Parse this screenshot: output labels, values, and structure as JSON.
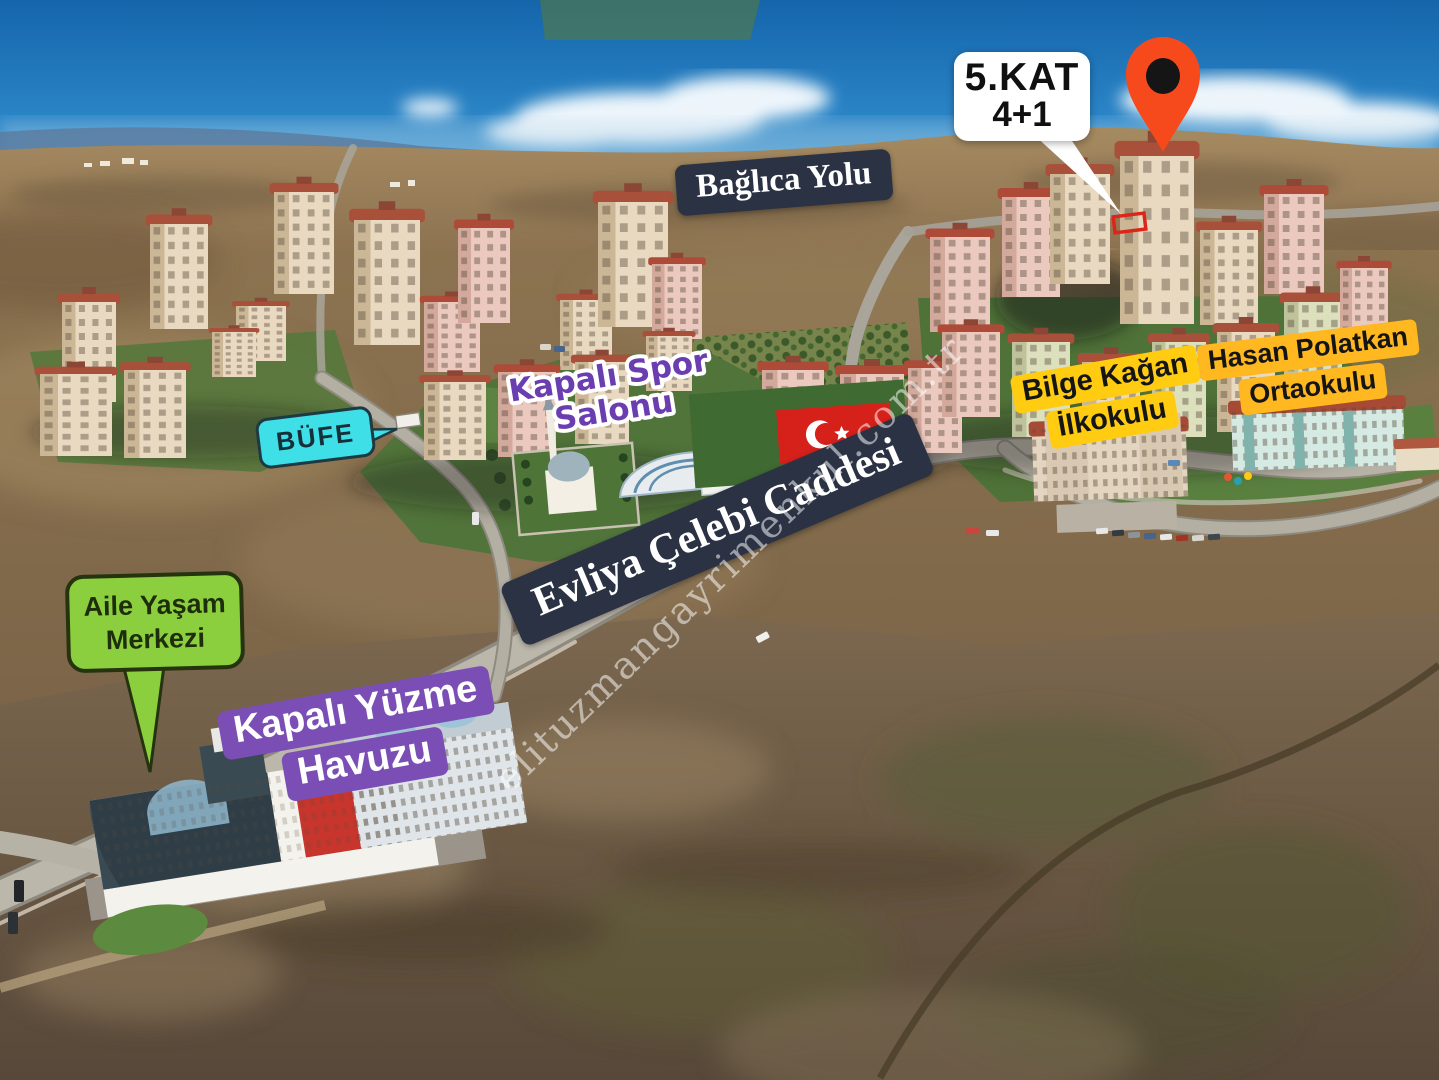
{
  "annotations": {
    "baglica_yolu": {
      "text": "Bağlıca Yolu",
      "bg": "#2b3244",
      "text_color": "#ffffff"
    },
    "unit_callout": {
      "line1": "5.KAT",
      "line2": "4+1",
      "bg": "#ffffff",
      "text_color": "#101010"
    },
    "map_pin": {
      "icon": "map-pin-icon",
      "color": "#f64a1d",
      "hole_color": "#151515"
    },
    "unit_highlight_box": {
      "color": "#dd2418"
    },
    "kapali_spor": {
      "line1": "Kapalı Spor",
      "line2": "Salonu",
      "text_color": "#6a3db0",
      "outline_color": "#ffffff"
    },
    "bufe": {
      "text": "BÜFE",
      "bg": "#3fdfe8",
      "border": "#1d3a42",
      "text_color": "#16303a"
    },
    "bilge_kagan": {
      "line1": "Bilge Kağan",
      "line2": "İlkokulu",
      "bg": "#ffcc11",
      "text_color": "#151515"
    },
    "hasan_polatkan": {
      "line1": "Hasan Polatkan",
      "line2": "Ortaokulu",
      "bg": "#ffb81f",
      "text_color": "#151515"
    },
    "evliya_celebi": {
      "text": "Evliya Çelebi Caddesi",
      "bg": "#2b3244",
      "text_color": "#ffffff"
    },
    "aile_yasam": {
      "line1": "Aile Yaşam",
      "line2": "Merkezi",
      "bg": "#8ccf3e",
      "border": "#26330f",
      "text_color": "#1e2d0b"
    },
    "kapali_yuzme": {
      "line1": "Kapalı Yüzme",
      "line2": "Havuzu",
      "bg": "#7a4eb5",
      "text_color": "#ffffff"
    },
    "watermark": {
      "text": "elituzmangayrimenkul.com.tr"
    }
  }
}
